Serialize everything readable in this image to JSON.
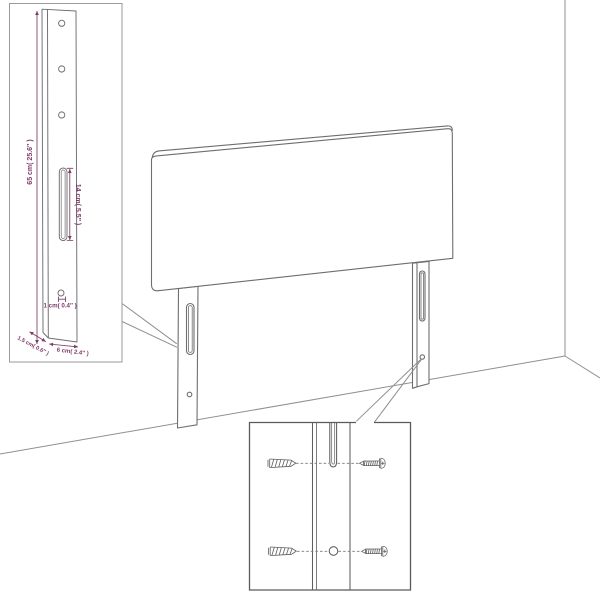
{
  "diagram": {
    "kind": "headboard-assembly-dimension-diagram",
    "colors": {
      "background": "#ffffff",
      "furniture_line": "#6e6e6e",
      "room_line": "#8f8f8f",
      "detail_line": "#5f5f5f",
      "box_border_left": "#9a9a9a",
      "box_border_right": "#5a5a5a",
      "dimension": "#7c3a67"
    },
    "detail_left": {
      "height_label": "65 cm( 25.6″ )",
      "slot_label": "14 cm( 5.5″ )",
      "hole_label": "1 cm( 0.4″ )",
      "depth_label": "1.5 cm( 0.6″ )",
      "width_label": "6 cm( 2.4″ )"
    }
  }
}
